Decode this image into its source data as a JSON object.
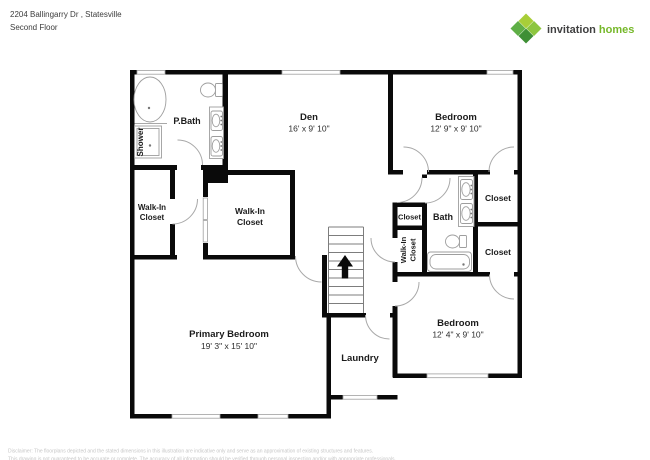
{
  "header": {
    "address": "2204 Ballingarry Dr , Statesville",
    "floor": "Second Floor"
  },
  "logo": {
    "brand_bold": "invitation",
    "brand_green": "homes",
    "icon": "four-green-diamonds",
    "colors": {
      "text_dark": "#404041",
      "text_green": "#76b82a",
      "diamond_light": "#a8ce38",
      "diamond_mid": "#8dc63f",
      "diamond_deep": "#5faf46",
      "diamond_dark": "#3e8f35"
    }
  },
  "floorplan": {
    "wall_color": "#0a0a0a",
    "rooms": {
      "pbath": {
        "name": "P.Bath"
      },
      "shower": {
        "name": "Shower"
      },
      "den": {
        "name": "Den",
        "dims": "16' x 9' 10\""
      },
      "bedroom_top": {
        "name": "Bedroom",
        "dims": "12' 9\" x 9' 10\""
      },
      "walkin_left": {
        "name_line1": "Walk-In",
        "name_line2": "Closet"
      },
      "walkin_mid": {
        "name_line1": "Walk-In",
        "name_line2": "Closet"
      },
      "closet_hall": {
        "name": "Closet"
      },
      "bath": {
        "name": "Bath"
      },
      "closet_top_right": {
        "name": "Closet"
      },
      "closet_bottom_right": {
        "name": "Closet"
      },
      "walkin_vertical": {
        "name_line1": "Walk-In",
        "name_line2": "Closet"
      },
      "primary_bedroom": {
        "name": "Primary Bedroom",
        "dims": "19' 3\" x 15' 10\""
      },
      "laundry": {
        "name": "Laundry"
      },
      "bedroom_bottom": {
        "name": "Bedroom",
        "dims": "12' 4\" x 9' 10\""
      }
    },
    "features": [
      "stairs-up-arrow",
      "door-swing-arcs",
      "windows",
      "tub",
      "shower-stall",
      "toilets",
      "double-sink-vanities",
      "bathtub"
    ]
  },
  "footer": {
    "disclaimer_line1": "Disclaimer: The floorplans depicted and the stated dimensions in this illustration are indicative only and serve as an approximation of existing structures and features.",
    "disclaimer_line2": "This drawing is not guaranteed to be accurate or complete. The accuracy of all information should be verified through personal inspection and/or with appropriate professionals."
  }
}
